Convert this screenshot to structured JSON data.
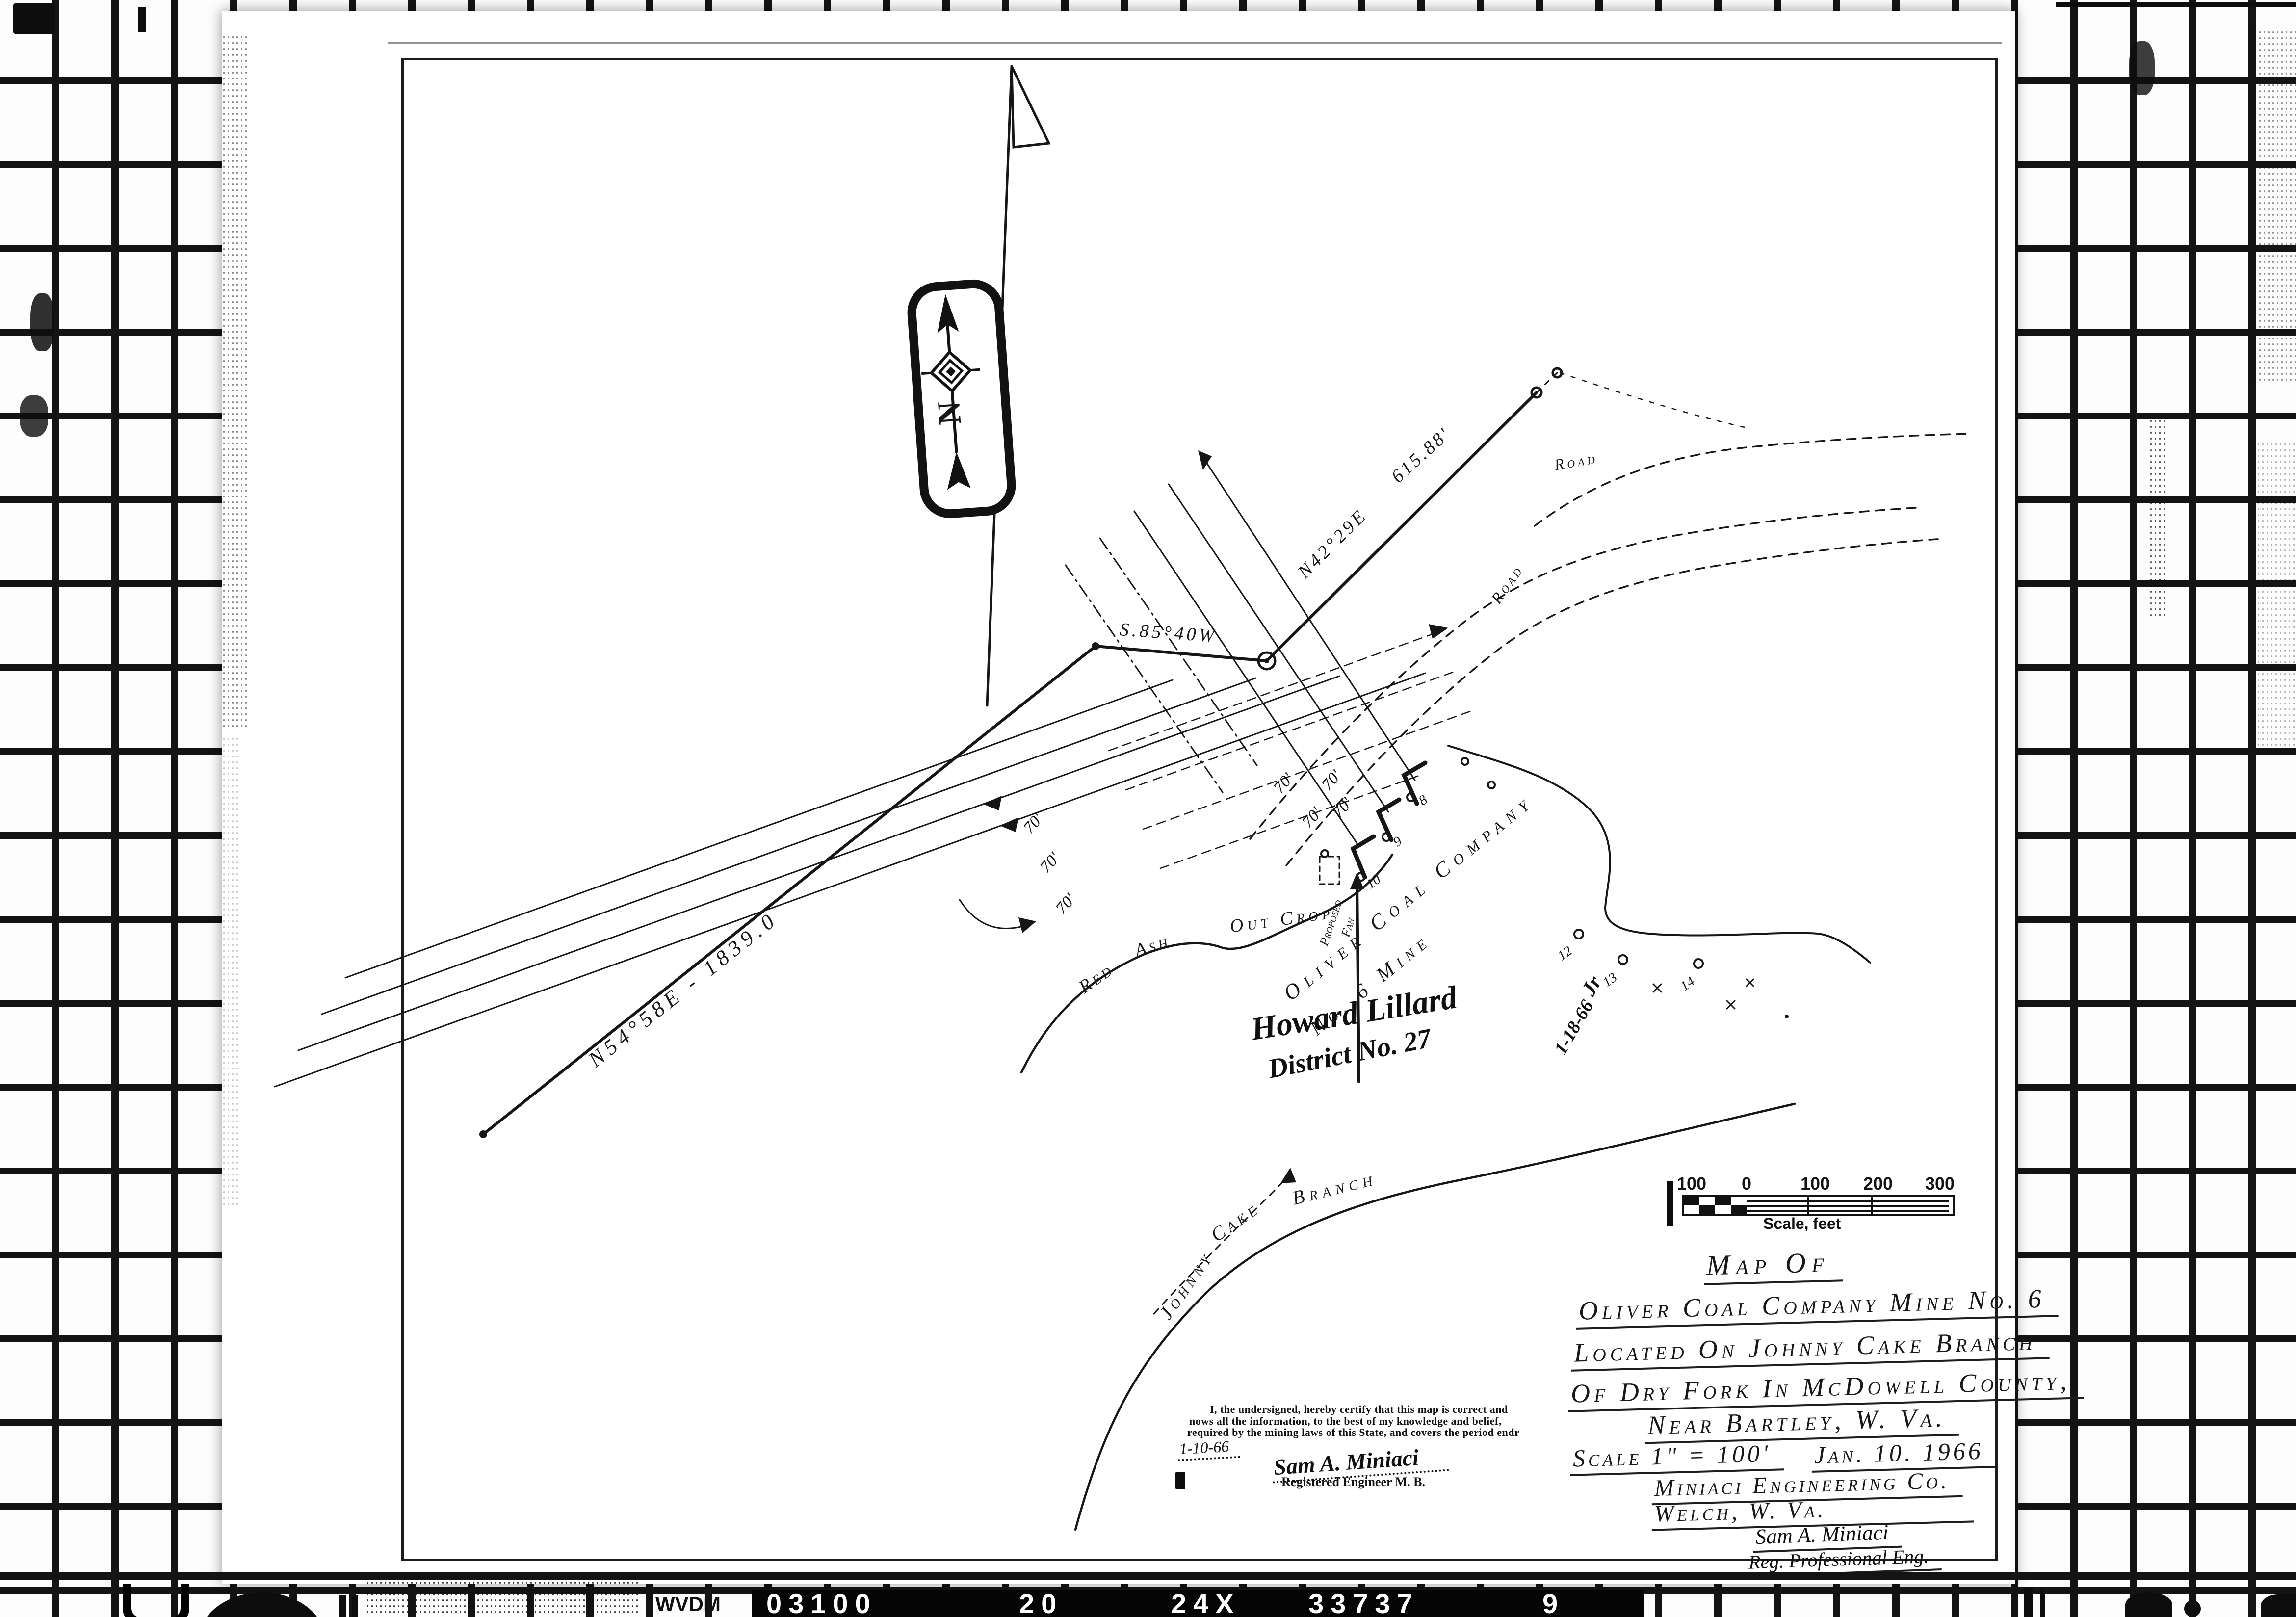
{
  "film": {
    "prefix": "WVDM",
    "code_segments": [
      "03100",
      "20",
      "24X",
      "33737",
      "9"
    ]
  },
  "compass": {
    "north": "N"
  },
  "survey": {
    "bearing_main": "N54°58E - 1839.0",
    "bearing_west": "S.85°40W",
    "bearing_ne": "N42°29E",
    "distance_ne": "615.88'",
    "spacing": "70'",
    "stations": {
      "s8": "8",
      "s9": "9",
      "s10": "10",
      "s12": "12",
      "s13": "13",
      "s14": "14"
    }
  },
  "map_labels": {
    "company": "Oliver Coal Company",
    "mine": "No. 6 Mine",
    "fan_word1": "Proposed",
    "fan_word2": "Fan",
    "outcrop_red": "Red",
    "outcrop_ash": "Ash",
    "outcrop": "Out Crop",
    "stream_word1": "Johnny",
    "stream_word2": "Cake",
    "stream_word3": "Branch",
    "road_upper": "Road",
    "road_lower": "Road"
  },
  "handwriting": {
    "inspector_line1": "Howard Lillard",
    "inspector_line2": "District No. 27",
    "initials": "Jr",
    "date": "1-18-66"
  },
  "scale_bar": {
    "ticks": [
      "100",
      "0",
      "100",
      "200",
      "300"
    ],
    "caption": "Scale, feet"
  },
  "title_block": {
    "line1": "Map Of",
    "line2": "Oliver Coal Company Mine No. 6",
    "line3": "Located On Johnny Cake Branch",
    "line4": "Of Dry Fork In McDowell County,",
    "line5": "Near Bartley, W. Va.",
    "scale": "Scale 1\" = 100'",
    "date": "Jan. 10. 1966",
    "firm": "Miniaci Engineering Co.",
    "firm_city": "Welch, W. Va.",
    "engineer": "Sam A. Miniaci",
    "engineer_title": "Reg. Professional Eng."
  },
  "certification": {
    "line1": "I, the undersigned, hereby certify that this map is correct and",
    "line2": "nows all the information, to the best of my knowledge and belief,",
    "line3": "required by the mining laws of this State, and covers the period endr",
    "date": "1-10-66",
    "signature": "Sam A. Miniaci",
    "reg_line": "Registered Engineer M. B."
  },
  "colors": {
    "ink": "#161616",
    "paper": "#ffffff",
    "film_black": "#060606"
  }
}
